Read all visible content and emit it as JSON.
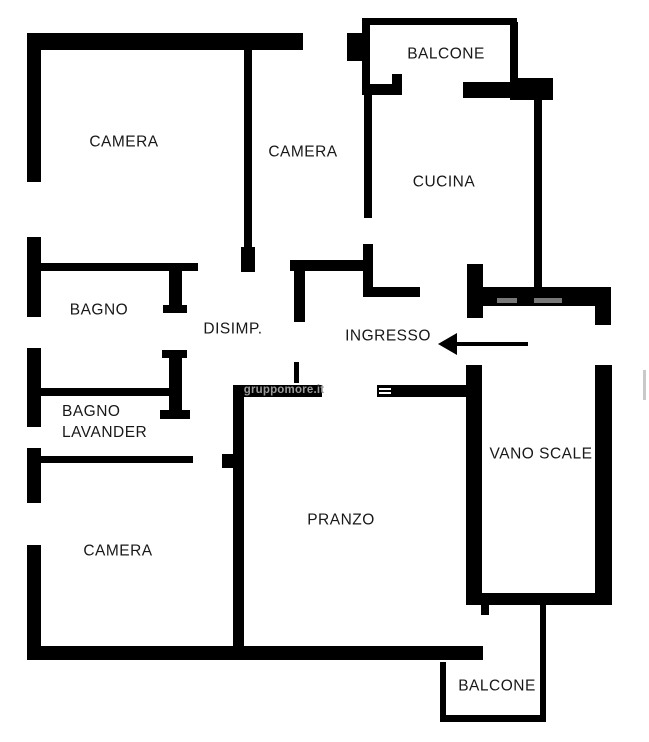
{
  "plan": {
    "background": "#ffffff",
    "wall_color": "#000000",
    "label_color": "#181818",
    "watermark": {
      "text": "gruppomore.it",
      "x": 284,
      "y": 390,
      "color": "#9a9a9a"
    },
    "arrow": {
      "tip_x": 438,
      "tail_x": 528,
      "y": 344,
      "direction": "left"
    },
    "rooms": [
      {
        "id": "camera-nw",
        "label": "CAMERA",
        "x": 124,
        "y": 142
      },
      {
        "id": "camera-n",
        "label": "CAMERA",
        "x": 303,
        "y": 152
      },
      {
        "id": "balcone-n",
        "label": "BALCONE",
        "x": 446,
        "y": 54
      },
      {
        "id": "cucina",
        "label": "CUCINA",
        "x": 444,
        "y": 182
      },
      {
        "id": "bagno",
        "label": "BAGNO",
        "x": 99,
        "y": 310
      },
      {
        "id": "disimp",
        "label": "DISIMP.",
        "x": 233,
        "y": 329
      },
      {
        "id": "ingresso",
        "label": "INGRESSO",
        "x": 388,
        "y": 336
      },
      {
        "id": "bagno-lavanderia",
        "label": "BAGNO LAVANDER",
        "lines": [
          "BAGNO",
          "LAVANDER"
        ],
        "anchor": "left",
        "x": 62,
        "y": 401
      },
      {
        "id": "vano-scale",
        "label": "VANO SCALE",
        "x": 541,
        "y": 454
      },
      {
        "id": "camera-sw",
        "label": "CAMERA",
        "x": 118,
        "y": 551
      },
      {
        "id": "pranzo",
        "label": "PRANZO",
        "x": 341,
        "y": 520
      },
      {
        "id": "balcone-s",
        "label": "BALCONE",
        "x": 497,
        "y": 686
      }
    ],
    "walls": [
      [
        27,
        33,
        276,
        17
      ],
      [
        27,
        33,
        14,
        149
      ],
      [
        27,
        237,
        14,
        80
      ],
      [
        27,
        348,
        14,
        79
      ],
      [
        27,
        448,
        14,
        55
      ],
      [
        27,
        545,
        14,
        112
      ],
      [
        27,
        646,
        456,
        14
      ],
      [
        244,
        50,
        8,
        222
      ],
      [
        241,
        247,
        14,
        25
      ],
      [
        38,
        263,
        160,
        8
      ],
      [
        169,
        263,
        13,
        49
      ],
      [
        163,
        305,
        24,
        8
      ],
      [
        41,
        388,
        132,
        8
      ],
      [
        169,
        350,
        13,
        68
      ],
      [
        162,
        350,
        25,
        8
      ],
      [
        160,
        410,
        30,
        9
      ],
      [
        41,
        456,
        152,
        7
      ],
      [
        222,
        454,
        13,
        14
      ],
      [
        233,
        385,
        11,
        265
      ],
      [
        233,
        385,
        89,
        12
      ],
      [
        377,
        385,
        89,
        12
      ],
      [
        379,
        388,
        12,
        2,
        "#ffffff"
      ],
      [
        379,
        392,
        12,
        2,
        "#ffffff"
      ],
      [
        294,
        362,
        5,
        21
      ],
      [
        362,
        18,
        155,
        7
      ],
      [
        362,
        18,
        8,
        77
      ],
      [
        347,
        33,
        17,
        28
      ],
      [
        510,
        22,
        8,
        62
      ],
      [
        510,
        78,
        43,
        22
      ],
      [
        463,
        82,
        48,
        16
      ],
      [
        362,
        84,
        40,
        11
      ],
      [
        392,
        74,
        10,
        21
      ],
      [
        364,
        93,
        8,
        125
      ],
      [
        363,
        244,
        10,
        53
      ],
      [
        290,
        260,
        83,
        11
      ],
      [
        294,
        269,
        11,
        53
      ],
      [
        373,
        287,
        47,
        10
      ],
      [
        467,
        264,
        16,
        54
      ],
      [
        483,
        287,
        115,
        19
      ],
      [
        497,
        298,
        20,
        5,
        "#787878"
      ],
      [
        534,
        298,
        28,
        5,
        "#787878"
      ],
      [
        595,
        287,
        16,
        38
      ],
      [
        534,
        95,
        8,
        197
      ],
      [
        466,
        365,
        16,
        238
      ],
      [
        595,
        365,
        17,
        238
      ],
      [
        466,
        593,
        146,
        12
      ],
      [
        481,
        603,
        8,
        12
      ],
      [
        540,
        605,
        6,
        117
      ],
      [
        440,
        715,
        106,
        7
      ],
      [
        440,
        662,
        6,
        57
      ],
      [
        643,
        370,
        3,
        30,
        "#c9c9c9"
      ]
    ]
  }
}
